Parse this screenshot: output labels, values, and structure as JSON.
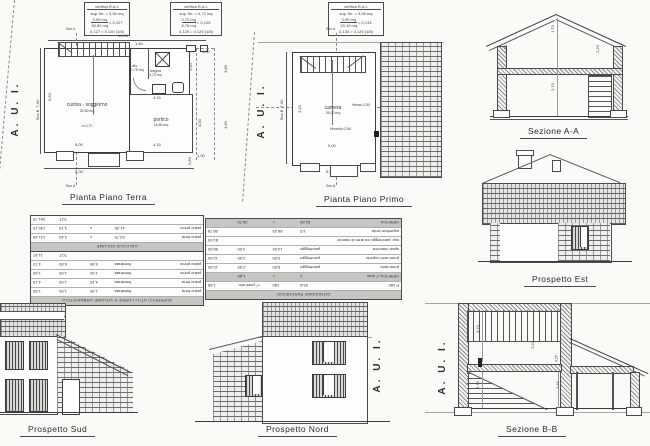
{
  "colors": {
    "paper": "#fafaf7",
    "ink": "#3c3c3c",
    "shade": "#c6c6c2"
  },
  "verifica_boxes": [
    {
      "title": "verifica R.A.I.",
      "sup": "sup. fin. = 3,90 mq",
      "num": "3,90 mq",
      "den": "30,50 mq",
      "res": "= 0,127",
      "check": "0,127 > 0,125 (1/8)"
    },
    {
      "title": "verifica R.A.I.",
      "sup": "sup. fin. = 0,72 mq",
      "num": "0,72 mq",
      "den": "5,76 mq",
      "res": "= 0,125",
      "check": "0,125 = 0,125 (1/8)"
    },
    {
      "title": "verifica R.A.I.",
      "sup": "sup. fin. = 3,90 mq",
      "num": "3,90 mq",
      "den": "29,10 mq",
      "res": "= 0,134",
      "check": "0,134 > 0,125 (1/8)"
    }
  ],
  "plan_terra": {
    "title": "Pianta Piano Terra",
    "aui": "A. U. I.",
    "sez_a_top": "Sez.A",
    "sez_a_bottom": "Sez.A",
    "sez_b": "Sez.B",
    "room_cucina": "cucina - soggiorno",
    "room_cucina_area": "30,50 mq",
    "room_cucina_h": "h=2,70",
    "room_dis": "dis.",
    "room_dis_area": "1,75 mq",
    "room_bagno": "bagno",
    "room_bagno_area": "3,75 mq",
    "room_portico": "portico",
    "room_portico_area": "16,60 mq",
    "dim_top": "10,05",
    "dim_left": "7,00",
    "dim_inner_left": "6,50",
    "dim_stairs": "1,50",
    "dim_bagno": "2,50",
    "dim_right_up": "3,80",
    "dim_right_low": "4,60",
    "dim_portico_top": "4,15",
    "dim_portico_right": "4,00",
    "dim_bottom_main": "5,00",
    "dim_bottom_portico": "4,15",
    "dim_bottom_out": "5,00",
    "dim_top_right": "1,00",
    "dim_corner_a": "1,00",
    "dim_corner_b": "0,80"
  },
  "plan_primo": {
    "title": "Pianta Piano Primo",
    "aui": "A. U. I.",
    "sez_a_top": "Sez.A",
    "sez_a_bottom": "Sez.A",
    "sez_b": "Sez.B",
    "room_camera": "camera",
    "room_camera_area": "26,00 mq",
    "h_max": "Hmax=2,50",
    "h_media": "Hmedia=2,56",
    "dim_left": "7,00",
    "dim_inner": "3,20",
    "dim_width": "5,00",
    "dim_bottom": "5,90"
  },
  "sezione_aa": {
    "title": "Sezione A-A",
    "dim_ridge": "1,70",
    "dim_left": "1,20",
    "dim_right": "2,20",
    "dim_floor": "2,70"
  },
  "prospetto_est": {
    "title": "Prospetto Est"
  },
  "prospetto_sud": {
    "title": "Prospetto Sud"
  },
  "prospetto_nord": {
    "title": "Prospetto Nord",
    "aui": "A. U. I."
  },
  "sezione_bb": {
    "title": "Sezione B-B",
    "aui": "A. U. I.",
    "dim_up": "3,70",
    "dim_mid": "2,22",
    "dim_low": "2,70",
    "dim_portico": "2,45",
    "dim_slab": "0,25"
  },
  "tables": {
    "sinistra": {
      "sections": [
        {
          "banner": "SUPERFICI UTILI LORDE E VOLUME URBANISTICO",
          "shaded": [],
          "rows": [
            [
              "piano terra",
              "finestrata",
              "1,00",
              "1,50",
              "1,50"
            ],
            [
              "piano terra",
              "finestrata",
              "4,15",
              "1,00",
              "4,15"
            ],
            [
              "piano primo",
              "finestrata",
              "1,00",
              "1,50",
              "1,50"
            ],
            [
              "piano primo",
              "finestrata",
              "5,90",
              "0,80",
              "4,72"
            ],
            [
              "",
              "",
              "",
              "TOT",
              "11,87"
            ]
          ]
        },
        {
          "banner": "CALCOLO VOLUME",
          "shaded": [],
          "rows": [
            [
              "piano terra",
              "53,75",
              "x",
              "2,45",
              "131,69"
            ],
            [
              "piano primo",
              "41,30",
              "x",
              "3,15",
              "130,10"
            ],
            [
              "",
              "",
              "",
              "TOT",
              "261,79"
            ]
          ]
        }
      ]
    },
    "parcheggi": {
      "sections": [
        {
          "banner": "DOTAZIONE PARCHEGGI",
          "shaded": [
            1,
            7
          ],
          "rows": [
            [
              "P 180",
              "93,8",
              "180",
              "n° posti min.",
              "1,88"
            ],
            [
              "VERIFICA n° auto",
              "2",
              ">",
              "1,88",
              ""
            ],
            [
              "posto auto",
              "parcheggio",
              "5,00",
              "2,50",
              "12,50"
            ],
            [
              "posto auto coperto",
              "parcheggio",
              "5,00",
              "2,50",
              "12,50"
            ],
            [
              "spazi manovra",
              "parcheggio",
              "14,00",
              "4,00",
              "56,00"
            ],
            [
              "sup. parcheggio ed aree di manovra",
              "",
              "",
              "",
              "81,00"
            ],
            [
              "superficie lorda",
              "1/3",
              "86,33",
              "",
              "28,78"
            ],
            [
              "VERIFICA",
              "81,00",
              ">",
              "28,76",
              ""
            ]
          ]
        }
      ]
    }
  }
}
